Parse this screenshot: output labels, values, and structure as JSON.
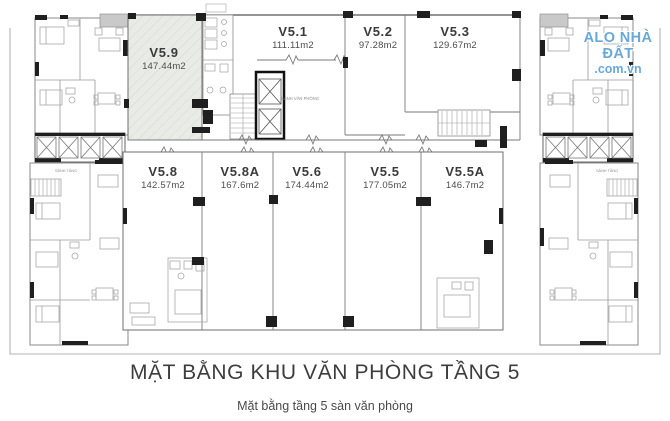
{
  "watermark": {
    "line1": "ALO NHÀ ĐẤT",
    "line2": ".com.vn"
  },
  "footer": {
    "title": "MẶT BẰNG KHU VĂN PHÒNG TẦNG 5",
    "subtitle": "Mặt bằng tầng 5 sàn văn phòng"
  },
  "plan_labels": {
    "office_lobby": "SẢNH VĂN PHÒNG",
    "wing_lobby": "SẢNH TẦNG"
  },
  "units": [
    {
      "name": "V5.9",
      "area": "147.44m2"
    },
    {
      "name": "V5.1",
      "area": "111.11m2"
    },
    {
      "name": "V5.2",
      "area": "97.28m2"
    },
    {
      "name": "V5.3",
      "area": "129.67m2"
    },
    {
      "name": "V5.8",
      "area": "142.57m2"
    },
    {
      "name": "V5.8A",
      "area": "167.6m2"
    },
    {
      "name": "V5.6",
      "area": "174.44m2"
    },
    {
      "name": "V5.5",
      "area": "177.05m2"
    },
    {
      "name": "V5.5A",
      "area": "146.7m2"
    }
  ],
  "colors": {
    "highlight_unit_fill": "#e9ece6",
    "watermark_blue": "#68a9da",
    "wall_dark": "#1f1f1f"
  }
}
